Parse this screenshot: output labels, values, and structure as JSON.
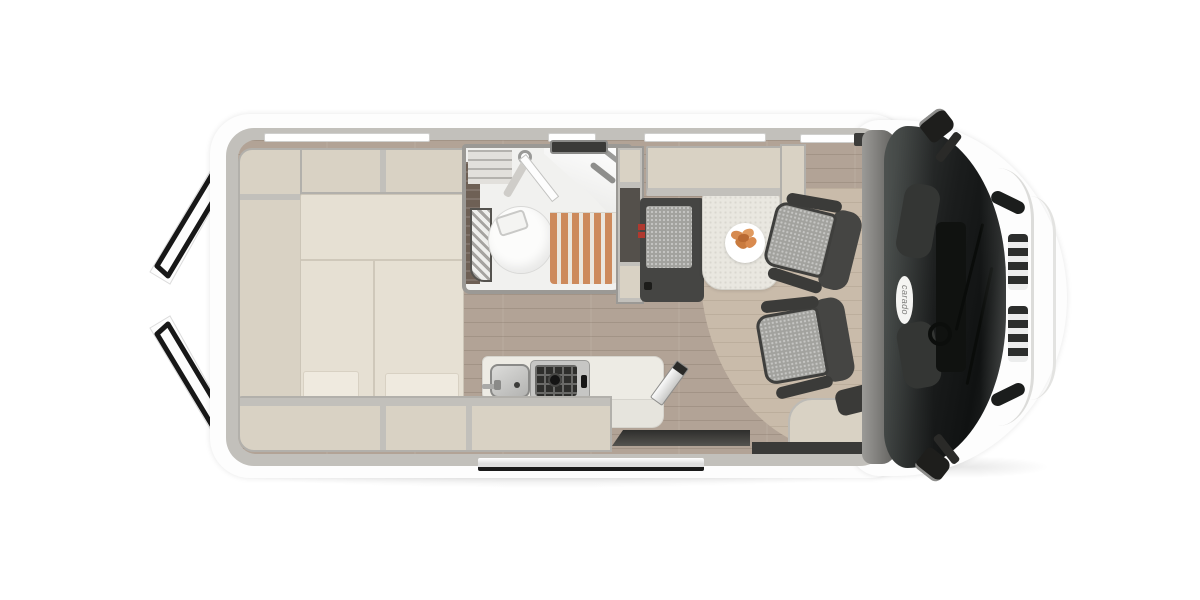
{
  "brand": {
    "logo_text": "carado"
  },
  "palette": {
    "body_white": "#fdfdfd",
    "interior_wall_gray": "#c2c0bb",
    "cabinet_beige": "#d9d2c4",
    "mattress_cream": "#e6e0d3",
    "counter_cream": "#edebe4",
    "floor_wood": "#b2a396",
    "floor_light_mat": "#c9bbaa",
    "shower_slats_wood": "#cd8a5c",
    "upholstery_dark": "#454543",
    "upholstery_light_gray": "#a2a29e",
    "windshield_dark": "#1d1f1f",
    "door_seal_black": "#171717",
    "seatbelt_buckle_red": "#b0392f",
    "food_orange": "#d98a4e"
  }
}
